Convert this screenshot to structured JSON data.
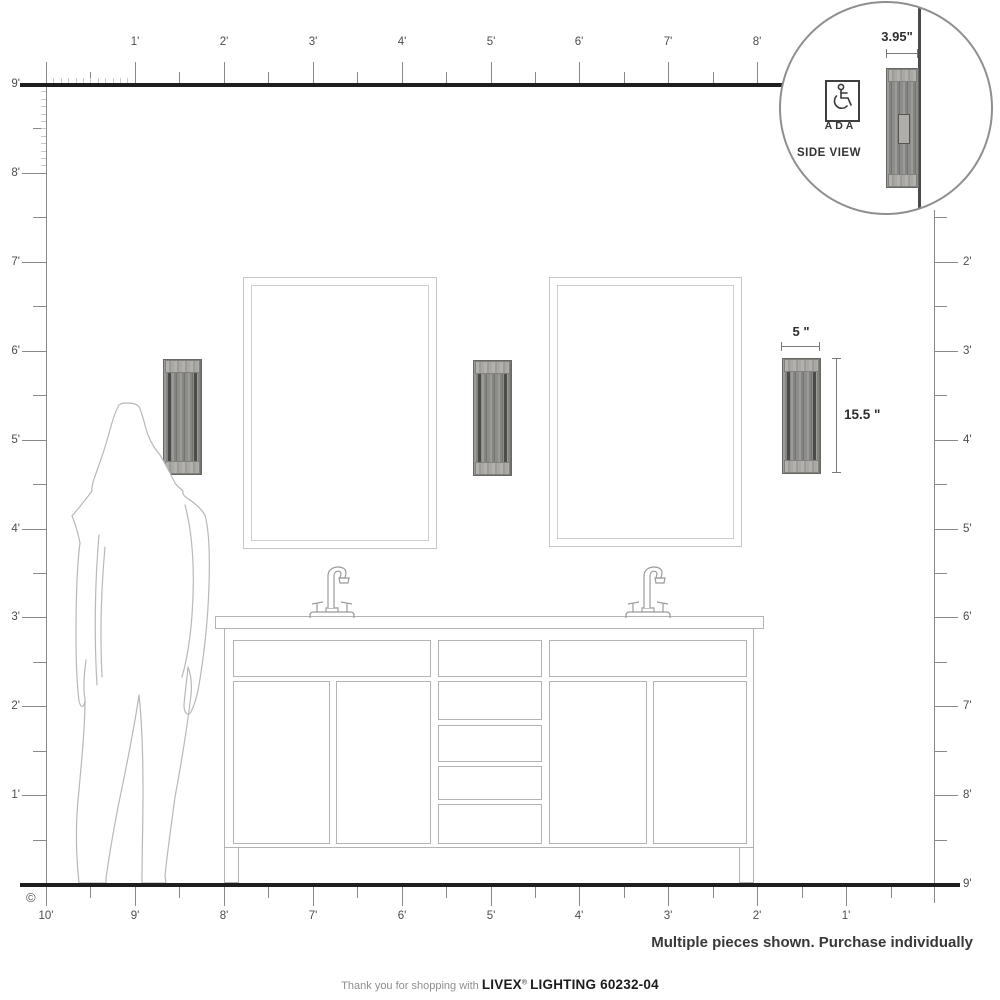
{
  "rulers": {
    "top": [
      "1'",
      "2'",
      "3'",
      "4'",
      "5'",
      "6'",
      "7'",
      "8'"
    ],
    "left": [
      "9'",
      "8'",
      "7'",
      "6'",
      "5'",
      "4'",
      "3'",
      "2'",
      "1'"
    ],
    "right": [
      "2'",
      "3'",
      "4'",
      "5'",
      "6'",
      "7'",
      "8'"
    ],
    "right_floor": "9'",
    "bottom": [
      "10'",
      "9'",
      "8'",
      "7'",
      "6'",
      "5'",
      "4'",
      "3'",
      "2'",
      "1'"
    ]
  },
  "inset": {
    "dim_label": "3.95\"",
    "ada_label": "ADA",
    "side_view_label": "SIDE VIEW"
  },
  "dimensions": {
    "width_label": "5 \"",
    "height_label": "15.5 \""
  },
  "purchase_note": "Multiple pieces shown. Purchase individually",
  "footer": {
    "prefix": "Thank you for shopping with",
    "brand": "LIVEX",
    "registered": "®",
    "rest": "LIGHTING 60232-04"
  },
  "copyright_symbol": "©",
  "colors": {
    "wall_line": "#1e1e1e",
    "ruler_line": "#8a8a8a",
    "outline_light": "#b3b3b3",
    "sconce_body": "#8d8d8b",
    "sconce_dark": "#4c4b49"
  }
}
